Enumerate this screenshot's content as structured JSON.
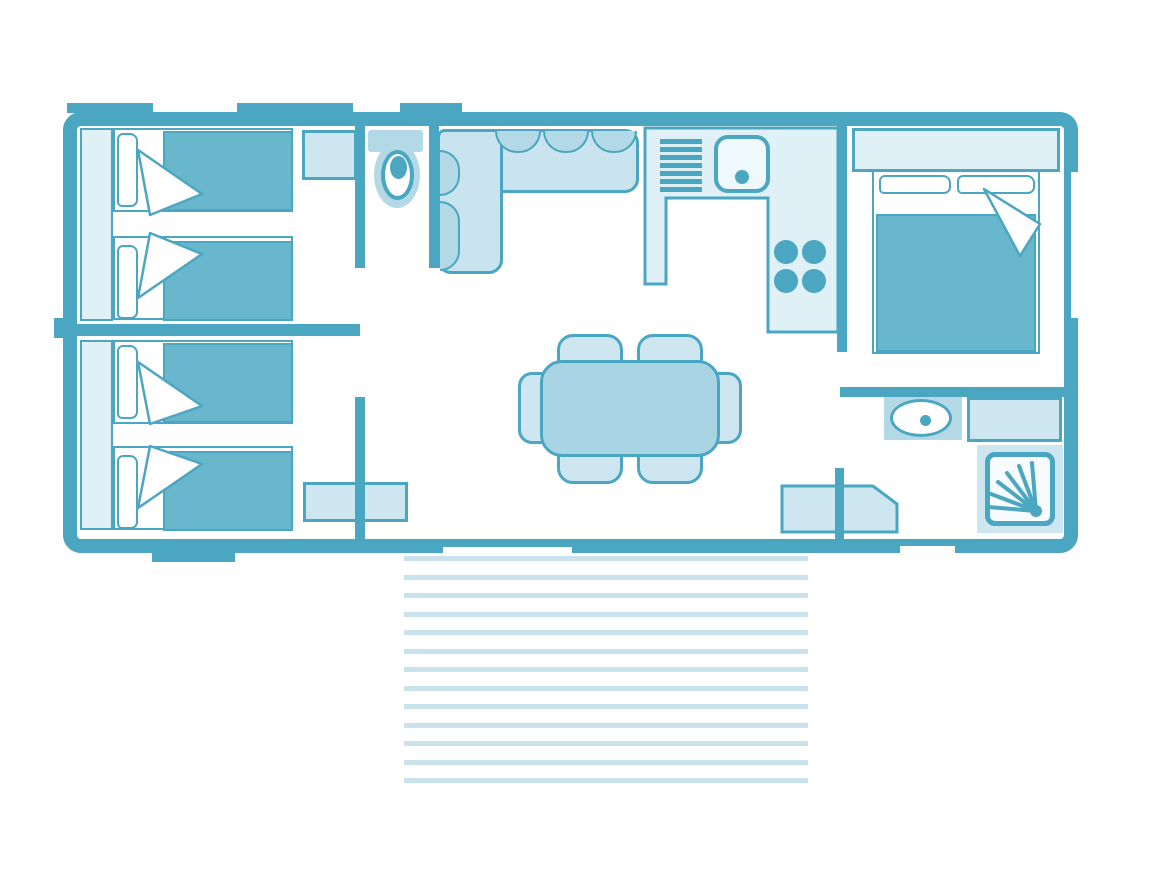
{
  "meta": {
    "description": "mobile-home floor plan, no visible text",
    "palette": {
      "wall": "#4ba6c1",
      "mattress": "#68b7cd",
      "table": "#a8d4e3",
      "sofa": "#c9e4ef",
      "cushion": "#b3d9e7",
      "light": "#cde6f0",
      "lighter": "#dff0f6",
      "sink": "#eff8fb",
      "shower_inner": "#f6fbfd",
      "stripe": "#c9e2ec",
      "white": "#ffffff"
    }
  },
  "floorplan": {
    "rooms": [
      {
        "name": "bedroom-twin-top",
        "furniture": [
          "wardrobe",
          "single-bed",
          "single-bed",
          "nightstand"
        ]
      },
      {
        "name": "bedroom-twin-bottom",
        "furniture": [
          "wardrobe",
          "single-bed",
          "single-bed",
          "cabinet"
        ]
      },
      {
        "name": "wc",
        "furniture": [
          "toilet"
        ]
      },
      {
        "name": "living-area",
        "furniture": [
          "corner-sofa",
          "dining-table",
          "six-chairs",
          "cabinet"
        ]
      },
      {
        "name": "kitchen",
        "furniture": [
          "counter",
          "drainer",
          "sink",
          "hob-4-burners"
        ]
      },
      {
        "name": "bedroom-double",
        "furniture": [
          "wardrobe",
          "double-bed"
        ]
      },
      {
        "name": "shower-room",
        "furniture": [
          "washbasin",
          "counter",
          "shower",
          "corner-cabinet"
        ]
      },
      {
        "name": "terrace",
        "furniture": [
          "decking"
        ]
      }
    ]
  },
  "terrace": {
    "stripe_count": 13,
    "top": 556,
    "step": 18.5
  }
}
